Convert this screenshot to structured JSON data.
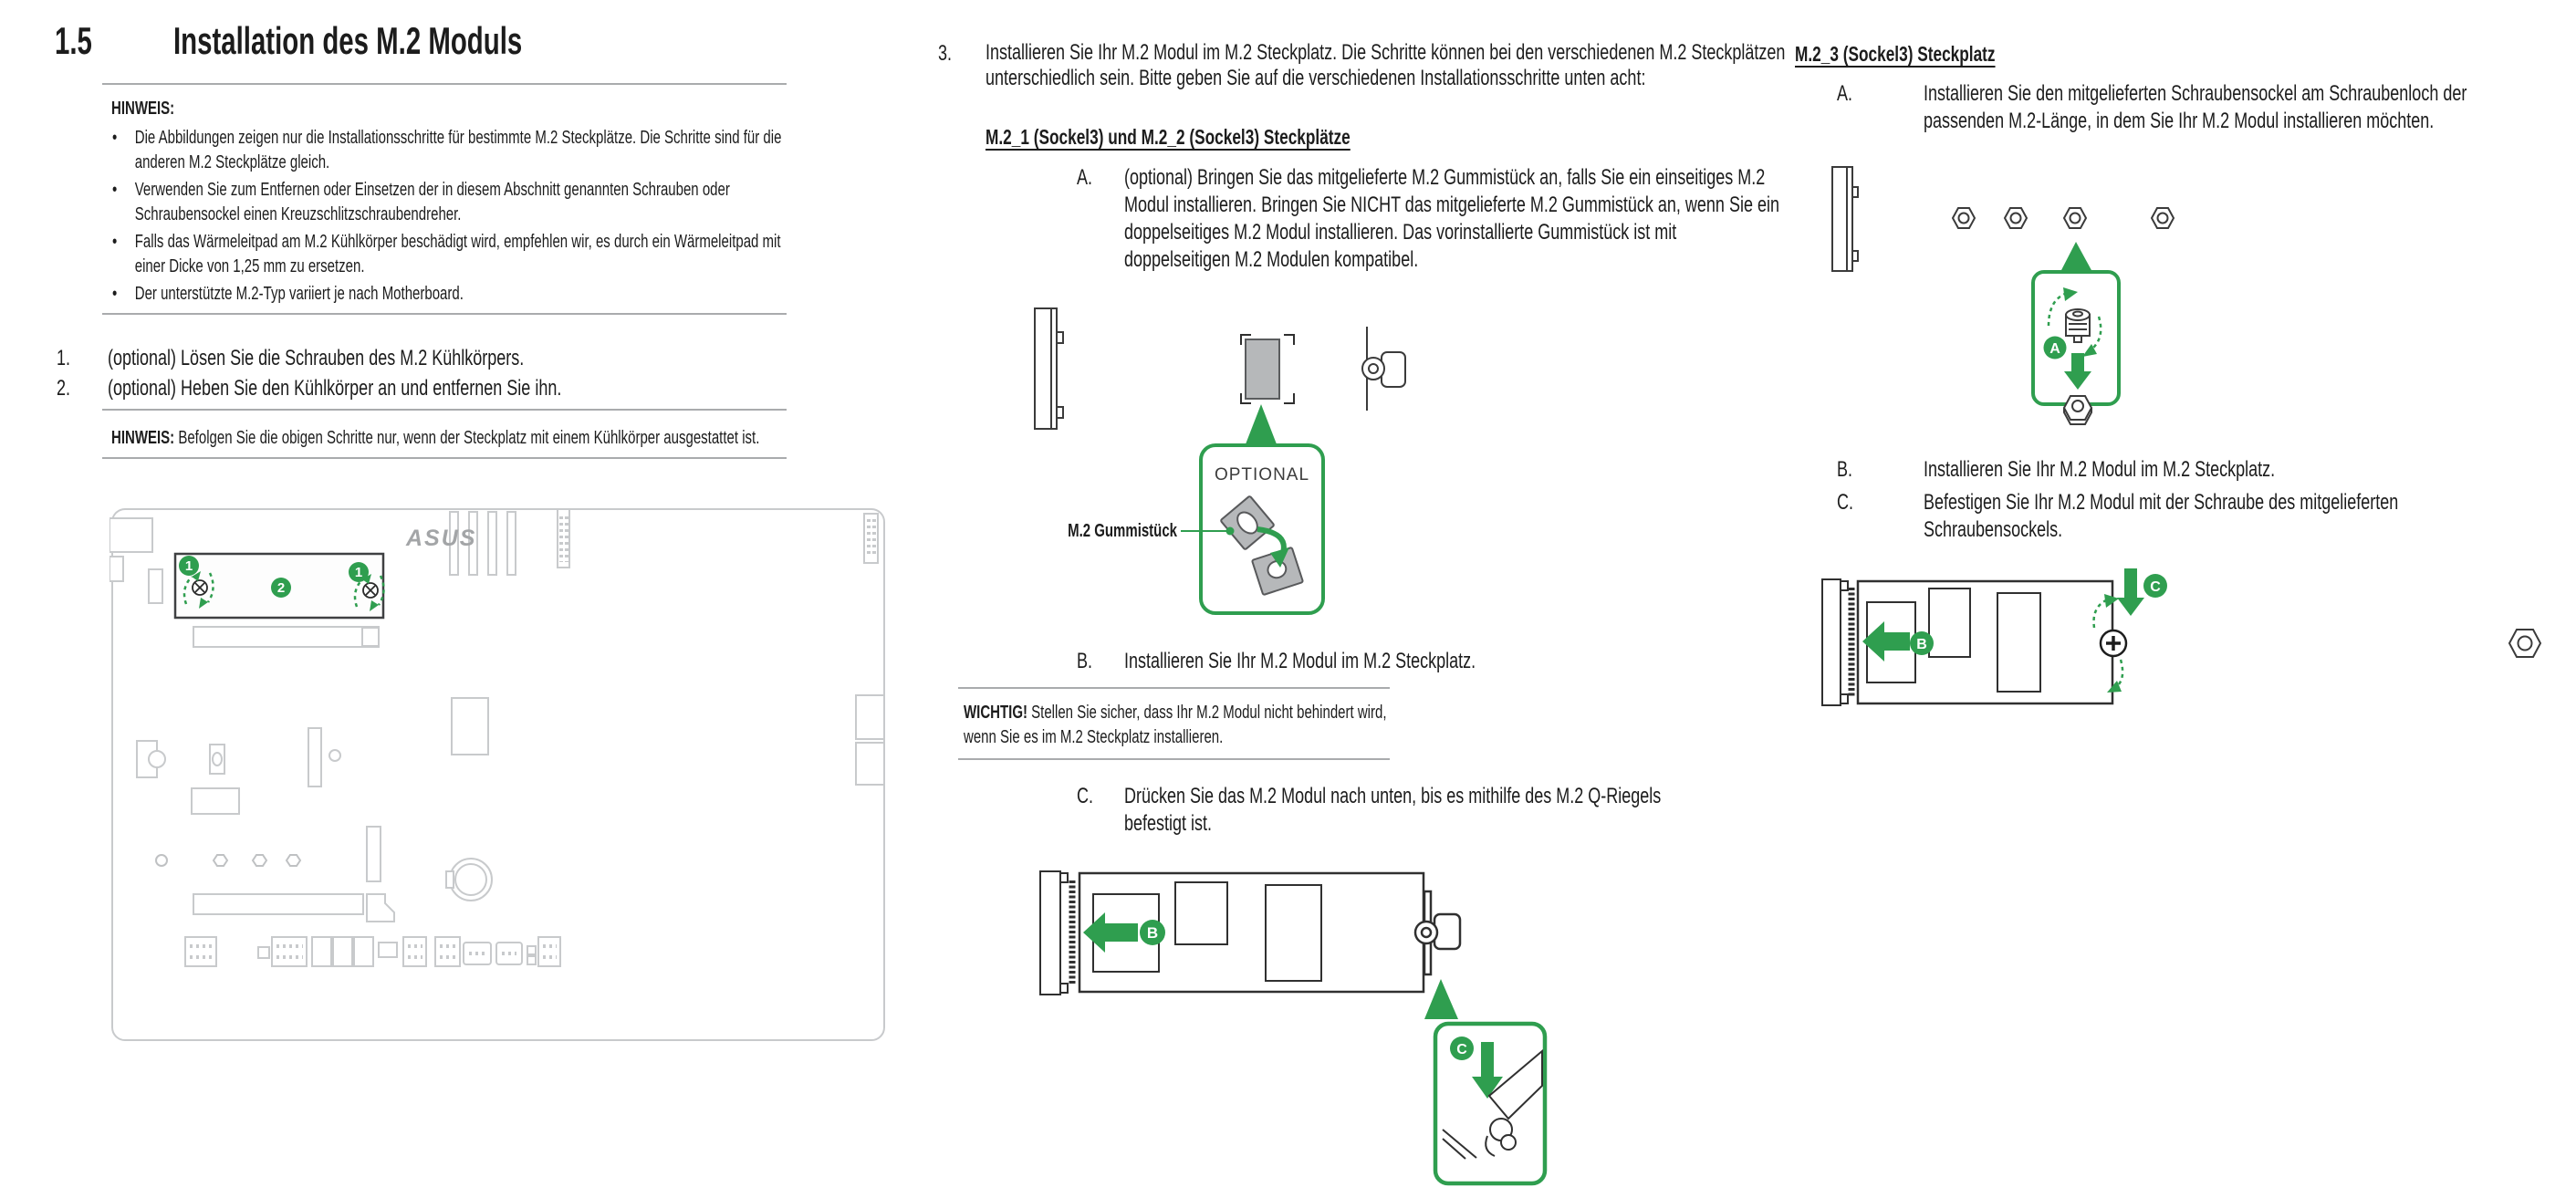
{
  "colors": {
    "green": "#2F9E4F",
    "text": "#1C1C1C",
    "rule_gray": "#A9ABAD",
    "board_line_gray": "#C8CACC",
    "pad_gray": "#B6B8BA",
    "logo_gray": "#A3A5A7"
  },
  "title": {
    "number": "1.5",
    "text": "Installation des M.2 Moduls"
  },
  "left": {
    "note1": {
      "label": "HINWEIS:",
      "bullets": [
        "Die Abbildungen zeigen nur die Installationsschritte für bestimmte M.2 Steckplätze. Die Schritte sind für die anderen M.2 Steckplätze gleich.",
        "Verwenden Sie zum Entfernen oder Einsetzen der in diesem Abschnitt genannten Schrauben oder Schraubensockel einen Kreuzschlitzschraubendreher.",
        "Falls das Wärmeleitpad am M.2 Kühlkörper beschädigt wird, empfehlen wir, es durch ein Wärmeleitpad mit einer Dicke von 1,25 mm zu ersetzen.",
        "Der unterstützte M.2-Typ variiert je nach Motherboard."
      ]
    },
    "step1_num": "1.",
    "step1": "(optional) Lösen Sie die Schrauben des M.2 Kühlkörpers.",
    "step2_num": "2.",
    "step2": "(optional) Heben Sie den Kühlkörper an und entfernen Sie ihn.",
    "note2_label": "HINWEIS:",
    "note2": "Befolgen Sie die obigen Schritte nur, wenn der Steckplatz mit einem Kühlkörper ausgestattet ist.",
    "board": {
      "logo": "ASUS",
      "badge_1": "1",
      "badge_2": "2"
    }
  },
  "middle": {
    "step3_num": "3.",
    "step3": "Installieren Sie Ihr M.2 Modul im M.2 Steckplatz. Die Schritte können bei den verschiedenen M.2 Steckplätzen unterschiedlich sein. Bitte geben Sie auf die verschiedenen Installationsschritte unten acht:",
    "heading": "M.2_1 (Sockel3) und M.2_2 (Sockel3) Steckplätze",
    "stepA_label": "A.",
    "stepA": "(optional) Bringen Sie das mitgelieferte M.2 Gummistück an, falls Sie ein einseitiges M.2 Modul installieren. Bringen Sie NICHT das mitgelieferte M.2 Gummistück an, wenn Sie ein doppelseitiges M.2 Modul installieren. Das vorinstallierte Gummistück ist mit doppelseitigen M.2 Modulen kompatibel.",
    "fig1": {
      "optional": "OPTIONAL",
      "pad_label": "M.2 Gummistück"
    },
    "stepB_label": "B.",
    "stepB": "Installieren Sie Ihr M.2 Modul im M.2 Steckplatz.",
    "important_label": "WICHTIG!",
    "important": "Stellen Sie sicher, dass Ihr M.2 Modul nicht behindert wird, wenn Sie es im M.2 Steckplatz installieren.",
    "stepC_label": "C.",
    "stepC": "Drücken Sie das M.2 Modul nach unten, bis es mithilfe des M.2 Q-Riegels befestigt ist.",
    "fig2": {
      "badge_b": "B",
      "badge_c": "C"
    }
  },
  "right": {
    "heading": "M.2_3 (Sockel3) Steckplatz",
    "stepA_label": "A.",
    "stepA": "Installieren Sie den mitgelieferten Schraubensockel am Schraubenloch der passenden M.2-Länge, in dem Sie Ihr M.2 Modul installieren möchten.",
    "fig1": {
      "badge_a": "A"
    },
    "stepB_label": "B.",
    "stepB": "Installieren Sie Ihr M.2 Modul im M.2 Steckplatz.",
    "stepC_label": "C.",
    "stepC": "Befestigen Sie Ihr M.2 Modul mit der Schraube des mitgelieferten Schraubensockels.",
    "fig2": {
      "badge_b": "B",
      "badge_c": "C"
    }
  }
}
